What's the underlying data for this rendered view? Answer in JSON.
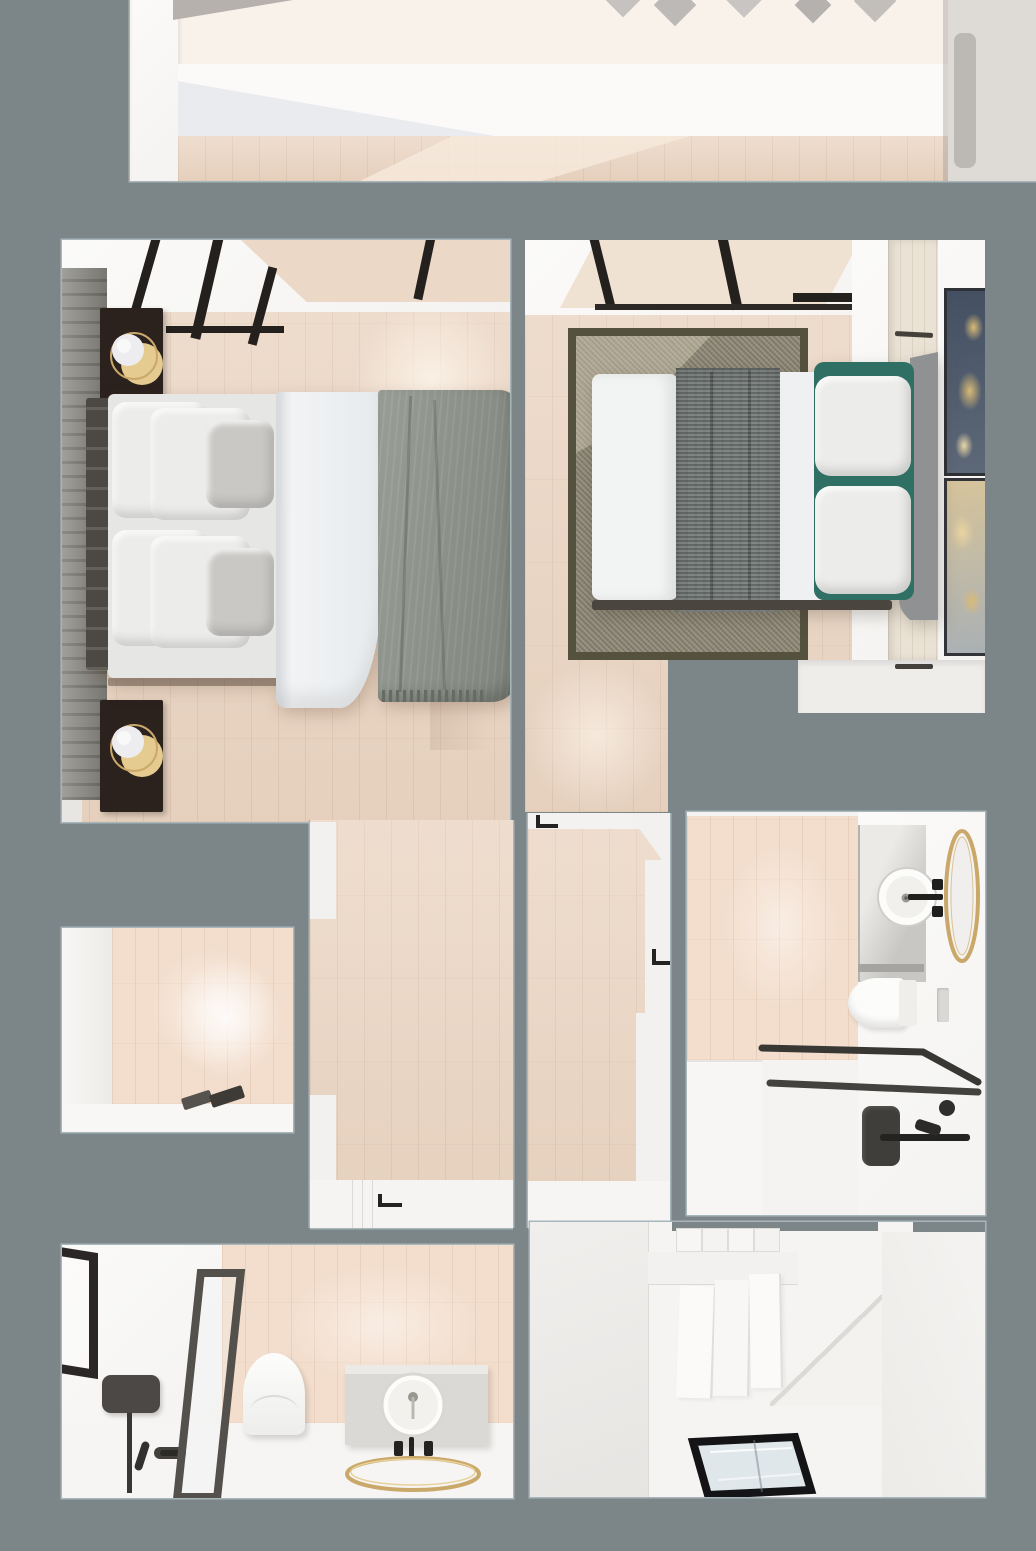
{
  "scene": {
    "name": "apartment-top-view-3d-floor-plan",
    "render_style": "photorealistic-3d-top-down-render",
    "visible_text": "none"
  },
  "colors": {
    "bg": "#7c8689",
    "room-border": "#a7b6bb",
    "floor": "#ead4c1",
    "floor-light": "#f6e9db",
    "tile": "#f3decd",
    "wall-white": "#f4f3f1",
    "wall-bright": "#fbfaf8",
    "wall-shadow": "#e8e6e3",
    "cream": "#f8f2eb",
    "charcoal": "#23201e",
    "dark-wood": "#2b211d",
    "frame-dark": "#3c3936",
    "slat-wall": "#8e8d87",
    "slat-line": "#76756f",
    "brass": "#c9a86a",
    "brass-light": "#e5cb8f",
    "duvet": "#f1f3f5",
    "pillow": "#ececea",
    "pillow-gray": "#c9c8c5",
    "blanket": "#8c9289",
    "fringe": "#666c64",
    "rug": "#8e8876",
    "rug-border": "#54513e",
    "runner": "#6f7573",
    "headboard-right": "#8f9193",
    "headboard-left": "#56524c",
    "teal": "#2f6f64",
    "art-navy": "#445062",
    "art-gold": "#d9ba77",
    "art-sand": "#d6c49a",
    "glass-floor": "#dfe7ea",
    "fixture-black": "#232321",
    "vanity-gray": "#dcdad6",
    "beige-panel": "#f0e2d2",
    "wardrobe-wood": "#eae2d4",
    "gray-blob": "#bcb8b4"
  },
  "rooms": [
    {
      "id": "top-hall",
      "label": "upper-hallway-partial",
      "furniture": [
        "white-wall",
        "wood-floor-strip",
        "wall-art-shapes"
      ]
    },
    {
      "id": "bedroom-left",
      "label": "bedroom-1",
      "furniture": [
        "glass-partition",
        "slatted-headboard-wall",
        "nightstand-top",
        "table-lamp-top",
        "nightstand-bottom",
        "table-lamp-bottom",
        "double-bed-vertical",
        "white-duvet",
        "gray-fringed-blanket",
        "white-pillows",
        "gray-cushions"
      ]
    },
    {
      "id": "bedroom-right",
      "label": "bedroom-2",
      "furniture": [
        "skylight-glazing",
        "area-rug",
        "double-bed-horizontal",
        "textured-runner-blanket",
        "white-pillows",
        "teal-accent-pillows",
        "scalloped-headboard",
        "wardrobe",
        "art-frame-navy",
        "art-frame-sand"
      ]
    },
    {
      "id": "corridor-left",
      "label": "corridor",
      "furniture": [
        "wood-floor",
        "door-threshold-bottom",
        "door-handle"
      ]
    },
    {
      "id": "hallway-center",
      "label": "hallway",
      "furniture": [
        "door-threshold-top",
        "door-handle-top",
        "door-handle-right",
        "wood-floor"
      ]
    },
    {
      "id": "bathroom-right",
      "label": "bathroom-1",
      "furniture": [
        "tiled-wall",
        "vanity-counter",
        "round-vessel-sink",
        "black-faucet",
        "gold-oval-mirror",
        "wall-hung-toilet",
        "flush-plate",
        "glass-shower-frame",
        "black-shower-panel",
        "hand-shower",
        "grab-bar"
      ]
    },
    {
      "id": "small-room-left",
      "label": "closet-room",
      "furniture": [
        "wood-wall",
        "floor-mat"
      ]
    },
    {
      "id": "bathroom-bottom",
      "label": "bathroom-2",
      "furniture": [
        "black-framed-window",
        "shower-glass-screen",
        "black-shower-head-panel",
        "shower-pipe",
        "floor-drain",
        "toilet",
        "vanity-cabinet",
        "round-basin",
        "black-taps",
        "gold-ring-mirror"
      ]
    },
    {
      "id": "stair-room",
      "label": "stair-landing",
      "furniture": [
        "staircase-steps",
        "diagonal-stair-wall",
        "glass-floor-hatch"
      ]
    }
  ]
}
